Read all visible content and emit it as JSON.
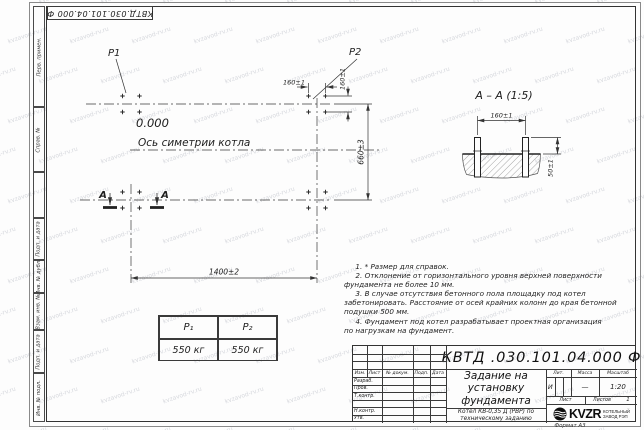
{
  "watermark": {
    "text": "kvzavod-rv.ru"
  },
  "frame": {
    "corner_doc_number": "КВТД.030.101.04.000 Ф",
    "format_label": "Формат А3",
    "left_strip": [
      "Перв. примен.",
      "Справ. №",
      "",
      "Подп. и дата",
      "Инв. № дубл.",
      "Взам. инв. №",
      "Подп. и дата",
      "Инв. № подл."
    ]
  },
  "plan": {
    "load1_label": "P1",
    "load2_label": "P2",
    "elevation": "0.000",
    "axis_label": "Ось симетрии котла",
    "dim_length": "1400±2",
    "dim_width": "660±3",
    "dim_bolt_spacing_h": "160±1",
    "dim_bolt_spacing_v": "160±1",
    "section_mark": "А"
  },
  "section_view": {
    "title": "А – А (1:5)",
    "dim_bolt_spacing": "160±1",
    "dim_bolt_height": "50±1"
  },
  "load_table": {
    "col1_header": "P₁",
    "col2_header": "P₂",
    "col1_value": "550 кг",
    "col2_value": "550 кг"
  },
  "notes": "     1. * Размер для справок.\n     2. Отклонение от горизонтального уровня верхней поверхности\nфундамента не более 10 мм.\n     3. В случае отсутствия бетонного пола площадку под котел\nзабетонировать. Расстояние от осей крайних колонн до края бетонной\nподушки 500 мм.\n     4. Фундамент под котел разрабатывает проектная организация\nпо нагрузкам на фундамент.",
  "title_block": {
    "doc_number": "КВТД .030.101.04.000 Ф",
    "doc_title": "Задание на\nустановку\nфундамента",
    "item_name": "Котел КВ-0,35 Д (РВР) по\nтехническому заданию",
    "col_izm": "Изм.",
    "col_list": "Лист",
    "col_doc": "№ докум.",
    "col_sign": "Подп.",
    "col_date": "Дата",
    "rows": [
      "Разраб.",
      "Пров.",
      "Т.контр.",
      "",
      "Н.контр.",
      "Утв."
    ],
    "lit_header": "Лит.",
    "lit_value": "И",
    "mass_header": "Масса",
    "mass_value": "—",
    "scale_header": "Масштаб",
    "scale_value": "1:20",
    "sheet_label": "Лист",
    "sheets_label": "Листов",
    "sheets_value": "1",
    "logo_text": "KVZR",
    "logo_caption": "КОТЕЛЬНЫЙ\nЗАВОД РЭП"
  }
}
